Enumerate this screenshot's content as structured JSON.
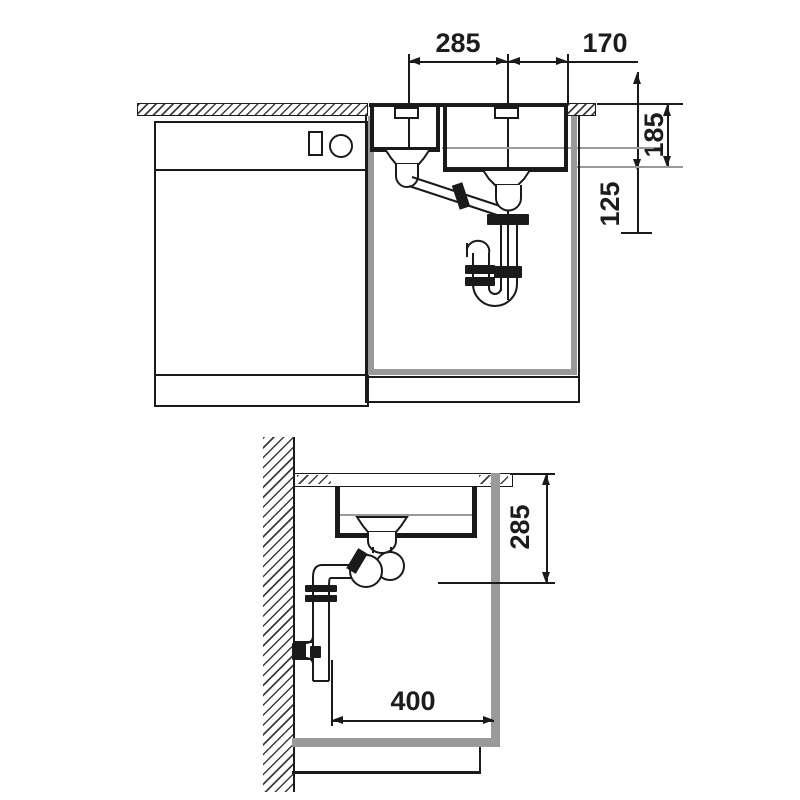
{
  "drawing_title": "sink installation technical drawing",
  "front_view": {
    "dim_top_left": "285",
    "dim_top_right": "170",
    "dim_bowl_depth": "185",
    "dim_outlet_offset": "125"
  },
  "side_view": {
    "dim_install_depth": "285",
    "dim_wall_clearance": "400"
  },
  "colors": {
    "line": "#1a1a1a",
    "gray": "#9a9a9a",
    "background": "#ffffff"
  }
}
